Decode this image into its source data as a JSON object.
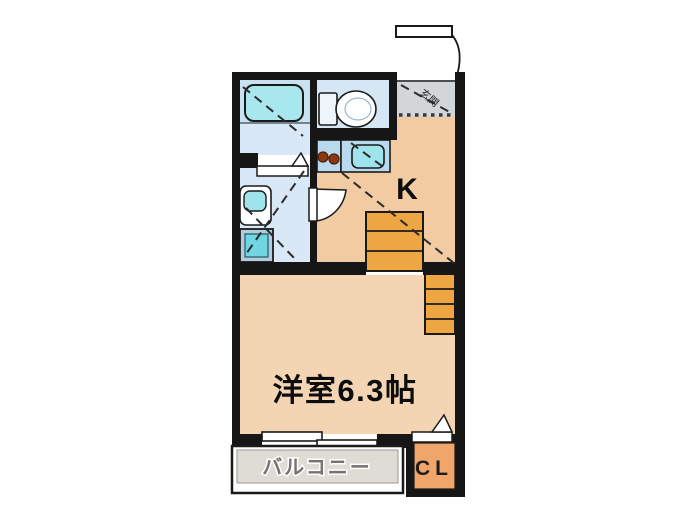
{
  "floor_plan": {
    "unit_labels": {
      "kitchen": "K",
      "main_room": "洋室6.3帖",
      "balcony": "バルコニー",
      "closet": "CL",
      "entrance": "玄関"
    },
    "main_room_size_tatami": "6.3",
    "rooms": [
      "bathroom",
      "toilet",
      "washroom",
      "entrance",
      "kitchen",
      "stairs",
      "main-room",
      "balcony",
      "closet"
    ],
    "fixtures": [
      "bathtub",
      "toilet-bowl",
      "kitchen-sink",
      "stove-burners",
      "washbasin",
      "washing-machine-pan",
      "staircase",
      "sliding-window",
      "entrance-door",
      "folding-doors"
    ],
    "colors": {
      "wall": "#161616",
      "wet_floor": "#d8e8f6",
      "fixture_cyan": "#9fe3ec",
      "counter_blue": "#b9daee",
      "kitchen_floor": "#f2cba3",
      "room_floor": "#f3d5b3",
      "entrance_gray": "#d2d6d9",
      "stairs_orange": "#eda641",
      "closet_orange": "#f0a66b",
      "balcony_gray": "#dfdcd5",
      "burner_brown": "#8a3a12"
    }
  }
}
